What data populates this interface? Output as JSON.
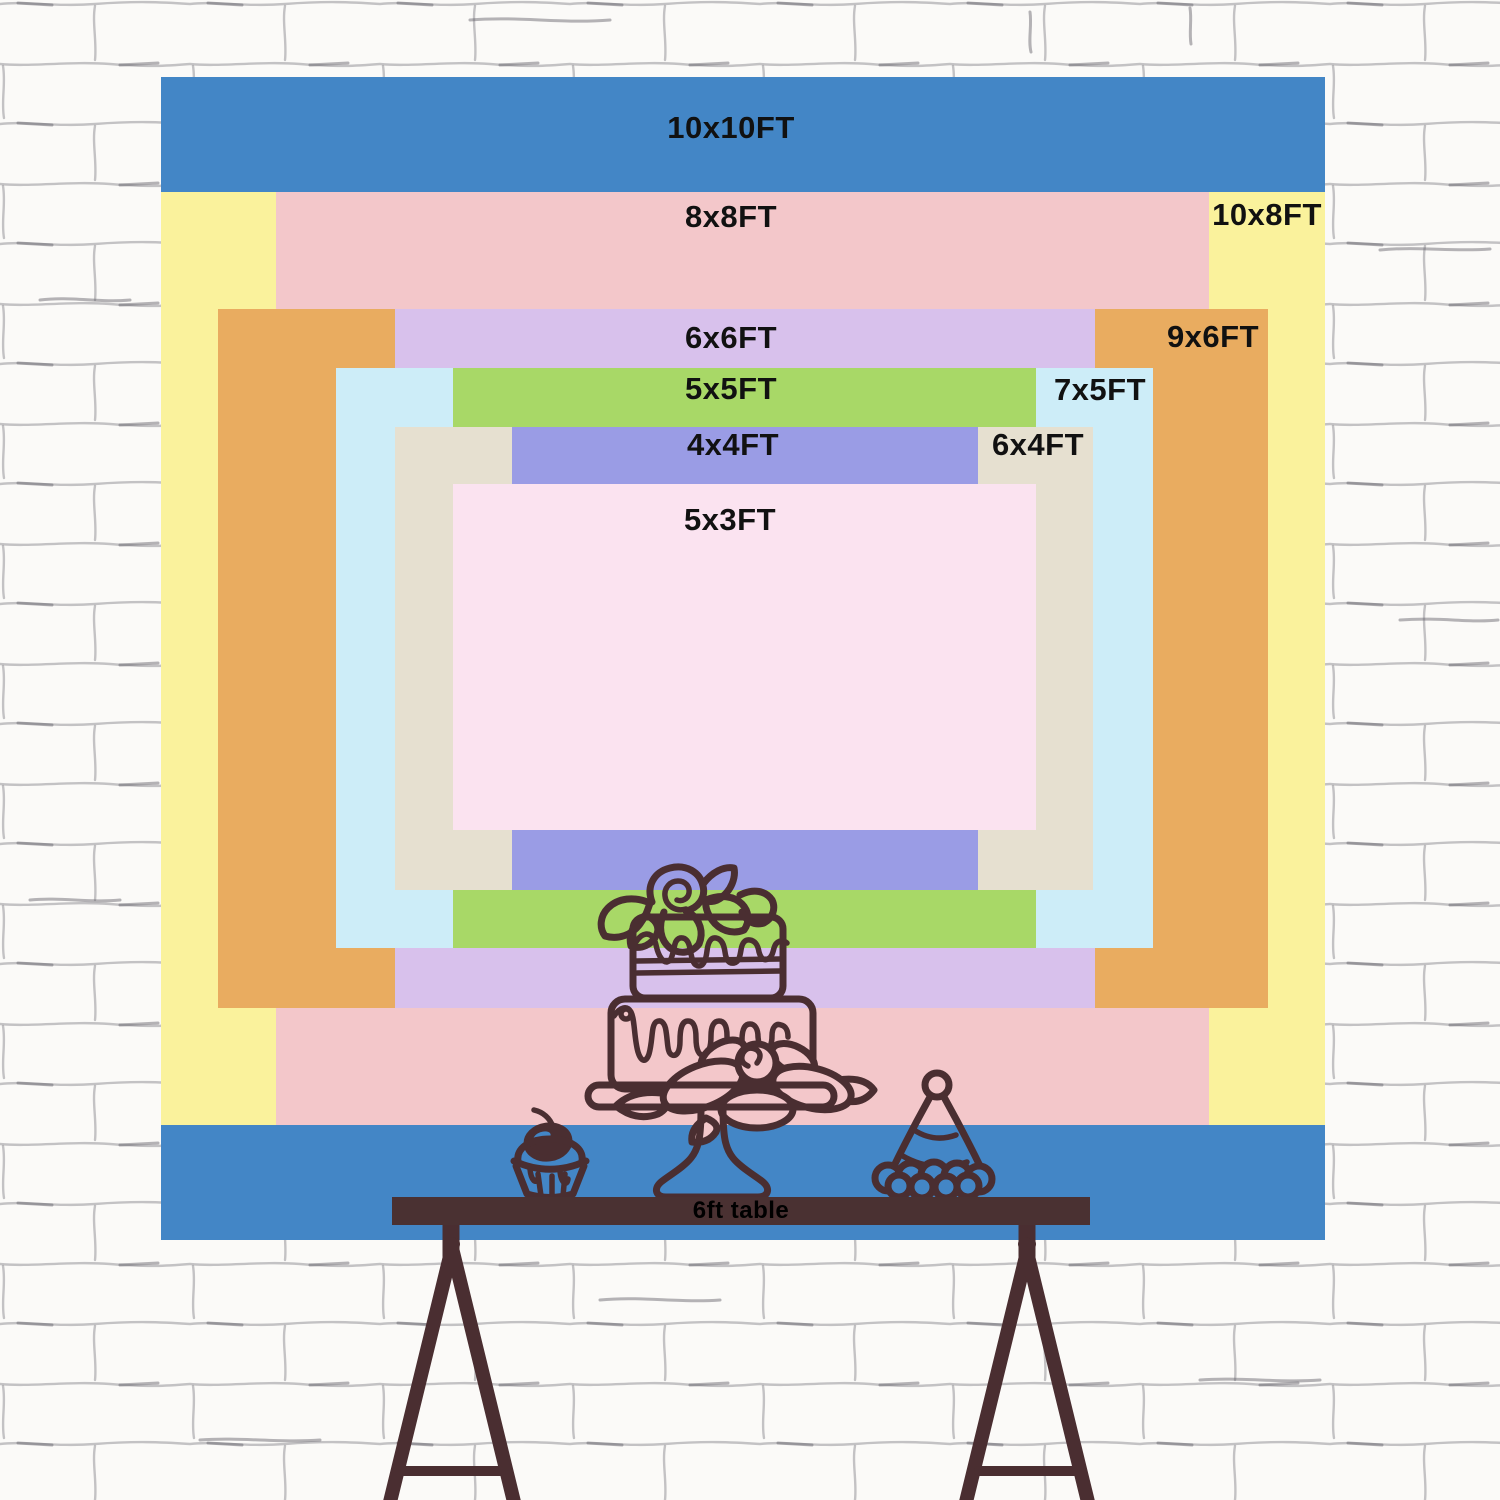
{
  "sizes": {
    "s10x10": {
      "label": "10x10FT",
      "color": "#4386c6"
    },
    "s10x8": {
      "label": "10x8FT",
      "color": "#faf29c"
    },
    "s8x8": {
      "label": "8x8FT",
      "color": "#f3c7ca"
    },
    "s9x6": {
      "label": "9x6FT",
      "color": "#e9ac60"
    },
    "s6x6": {
      "label": "6x6FT",
      "color": "#d8c1ec"
    },
    "s7x5": {
      "label": "7x5FT",
      "color": "#cdedf8"
    },
    "s5x5": {
      "label": "5x5FT",
      "color": "#a8d867"
    },
    "s6x4": {
      "label": "6x4FT",
      "color": "#e6e0d0"
    },
    "s4x4": {
      "label": "4x4FT",
      "color": "#9a9ce5"
    },
    "s5x3": {
      "label": "5x3FT",
      "color": "#fbe3f0"
    }
  },
  "label_text_color": "#111111",
  "table": {
    "label": "6ft table",
    "bar_color": "#4a3132",
    "label_color": "#000000"
  },
  "illustration": {
    "line_color": "#4a2e31",
    "petal_fill": "#f3c7ca",
    "items": [
      "two-tier-cake-on-stand",
      "cupcake-with-cherry",
      "party-hat",
      "trestle-table"
    ]
  },
  "wall": {
    "base_color": "#fbfaf8",
    "mortar_color": "#8b8a90",
    "accent_color": "#5d5c64"
  }
}
